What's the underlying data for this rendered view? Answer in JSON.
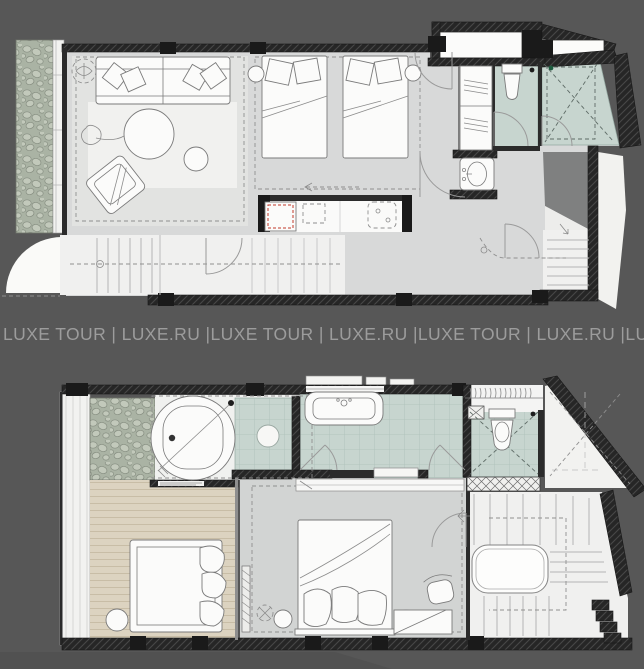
{
  "watermark": {
    "text": "LUXE TOUR | LUXE.RU |LUXE TOUR | LUXE.RU |LUXE TOUR | LUXE.RU |LUXE TOUR | LUXE.RU |LUXE T"
  },
  "palette": {
    "bg": "#575757",
    "band_text": "#9c9c9c",
    "wall": "#262626",
    "wall_hatch": "#474747",
    "floor": "#d8d9d9",
    "floor_light": "#e2e3e1",
    "white": "#f4f4f3",
    "rug": "#f1f1ef",
    "teal": "#c7d5cf",
    "teal_grid": "#adc0b9",
    "pebble_bg": "#aab3a4",
    "pebble": "#c2c9bb",
    "wood": "#dcd3c0",
    "wood_line": "#c8bda6",
    "shadow": "#7f8080",
    "stairs": "#f0f0ef",
    "stroke": "#7a7a7a",
    "accent_red": "#c0392b"
  }
}
